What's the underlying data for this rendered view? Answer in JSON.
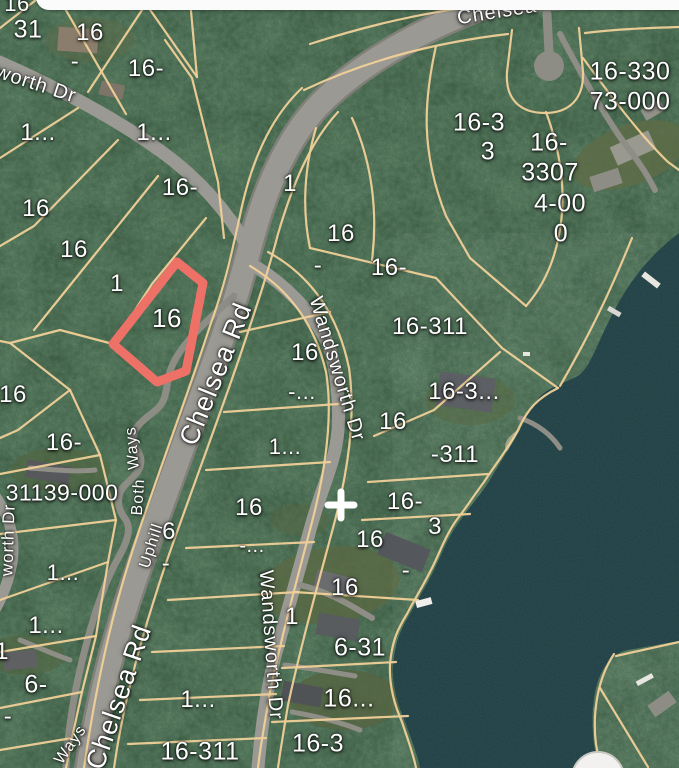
{
  "map_type": "satellite-parcel-map",
  "colors": {
    "forest": "#2e4c36",
    "water": "#1e3e43",
    "road": "#9a9993",
    "line": "#f0d098",
    "highlight": "#ee7168",
    "label": "#ffffff",
    "sheet": "#fbfbfb"
  },
  "highlight_parcel": {
    "label": "16"
  },
  "marker": {
    "symbol": "+"
  },
  "parcel_labels": [
    {
      "text": "16",
      "x": 17,
      "y": 4,
      "size": 22
    },
    {
      "text": "31",
      "x": 28,
      "y": 30,
      "size": 25
    },
    {
      "text": "16",
      "x": 90,
      "y": 33,
      "size": 24
    },
    {
      "text": "-",
      "x": 75,
      "y": 62,
      "size": 24
    },
    {
      "text": "16-",
      "x": 146,
      "y": 69,
      "size": 24
    },
    {
      "text": "1...",
      "x": 38,
      "y": 133,
      "size": 24
    },
    {
      "text": "1...",
      "x": 154,
      "y": 133,
      "size": 24
    },
    {
      "text": "16-",
      "x": 180,
      "y": 188,
      "size": 24
    },
    {
      "text": "16",
      "x": 36,
      "y": 209,
      "size": 24
    },
    {
      "text": "16",
      "x": 74,
      "y": 250,
      "size": 24
    },
    {
      "text": "1",
      "x": 290,
      "y": 184,
      "size": 24
    },
    {
      "text": "1",
      "x": 117,
      "y": 284,
      "size": 24
    },
    {
      "text": "16",
      "x": 167,
      "y": 318,
      "size": 26
    },
    {
      "text": "16",
      "x": 341,
      "y": 234,
      "size": 24
    },
    {
      "text": "-",
      "x": 318,
      "y": 266,
      "size": 24
    },
    {
      "text": "16-",
      "x": 389,
      "y": 268,
      "size": 24
    },
    {
      "text": "16-330",
      "x": 630,
      "y": 72,
      "size": 25
    },
    {
      "text": "73-000",
      "x": 630,
      "y": 102,
      "size": 25
    },
    {
      "text": "16-3",
      "x": 479,
      "y": 123,
      "size": 25
    },
    {
      "text": "3",
      "x": 488,
      "y": 152,
      "size": 25
    },
    {
      "text": "16-",
      "x": 549,
      "y": 143,
      "size": 25
    },
    {
      "text": "3307",
      "x": 550,
      "y": 173,
      "size": 25
    },
    {
      "text": "4-00",
      "x": 560,
      "y": 204,
      "size": 25
    },
    {
      "text": "0",
      "x": 561,
      "y": 234,
      "size": 25
    },
    {
      "text": "16-311",
      "x": 430,
      "y": 327,
      "size": 24
    },
    {
      "text": "16",
      "x": 305,
      "y": 353,
      "size": 24
    },
    {
      "text": "-...",
      "x": 302,
      "y": 392,
      "size": 22
    },
    {
      "text": "16-3...",
      "x": 464,
      "y": 392,
      "size": 24
    },
    {
      "text": "16",
      "x": 393,
      "y": 422,
      "size": 24
    },
    {
      "text": "-311",
      "x": 455,
      "y": 455,
      "size": 24
    },
    {
      "text": "1...",
      "x": 285,
      "y": 447,
      "size": 22
    },
    {
      "text": "16",
      "x": 13,
      "y": 395,
      "size": 24
    },
    {
      "text": "16-",
      "x": 64,
      "y": 443,
      "size": 24
    },
    {
      "text": "31139-000",
      "x": 62,
      "y": 493,
      "size": 23
    },
    {
      "text": "16",
      "x": 249,
      "y": 508,
      "size": 24
    },
    {
      "text": "-...",
      "x": 252,
      "y": 546,
      "size": 20
    },
    {
      "text": "6",
      "x": 169,
      "y": 532,
      "size": 24
    },
    {
      "text": "-",
      "x": 166,
      "y": 564,
      "size": 24
    },
    {
      "text": "16-",
      "x": 405,
      "y": 502,
      "size": 24
    },
    {
      "text": "3",
      "x": 435,
      "y": 527,
      "size": 24
    },
    {
      "text": "16",
      "x": 370,
      "y": 540,
      "size": 24
    },
    {
      "text": "-",
      "x": 406,
      "y": 571,
      "size": 24
    },
    {
      "text": "16",
      "x": 345,
      "y": 588,
      "size": 24
    },
    {
      "text": "1",
      "x": 292,
      "y": 617,
      "size": 24
    },
    {
      "text": "1...",
      "x": 63,
      "y": 573,
      "size": 22
    },
    {
      "text": "1...",
      "x": 46,
      "y": 626,
      "size": 24
    },
    {
      "text": "1",
      "x": 2,
      "y": 652,
      "size": 24
    },
    {
      "text": "6-",
      "x": 36,
      "y": 685,
      "size": 25
    },
    {
      "text": "-",
      "x": 8,
      "y": 717,
      "size": 24
    },
    {
      "text": "6-31",
      "x": 360,
      "y": 648,
      "size": 25
    },
    {
      "text": "16...",
      "x": 349,
      "y": 699,
      "size": 25
    },
    {
      "text": "1...",
      "x": 198,
      "y": 700,
      "size": 24
    },
    {
      "text": "16-311",
      "x": 200,
      "y": 752,
      "size": 25
    },
    {
      "text": "16-3",
      "x": 318,
      "y": 744,
      "size": 25
    }
  ],
  "road_labels": [
    {
      "text": "Chelsea",
      "x": 497,
      "y": 12,
      "rot": -9,
      "size": 20
    },
    {
      "text": "Chelsea Rd",
      "x": 216,
      "y": 374,
      "rot": -68,
      "size": 27
    },
    {
      "text": "Chelsea Rd",
      "x": 119,
      "y": 697,
      "rot": -71,
      "size": 27
    },
    {
      "text": "Wandsworth Dr",
      "x": 337,
      "y": 369,
      "rot": 73,
      "size": 20
    },
    {
      "text": "Wandsworth Dr",
      "x": 271,
      "y": 645,
      "rot": 86,
      "size": 20
    },
    {
      "text": "worth Dr",
      "x": 36,
      "y": 84,
      "rot": 18,
      "size": 20
    },
    {
      "text": "worth Dr",
      "x": 8,
      "y": 540,
      "rot": -88,
      "size": 17
    },
    {
      "text": "Ways",
      "x": 133,
      "y": 448,
      "rot": -95,
      "size": 16
    },
    {
      "text": "Both",
      "x": 139,
      "y": 497,
      "rot": -86,
      "size": 16
    },
    {
      "text": "Uphill",
      "x": 152,
      "y": 546,
      "rot": -72,
      "size": 16
    },
    {
      "text": "Ways",
      "x": 71,
      "y": 745,
      "rot": -55,
      "size": 16
    }
  ]
}
